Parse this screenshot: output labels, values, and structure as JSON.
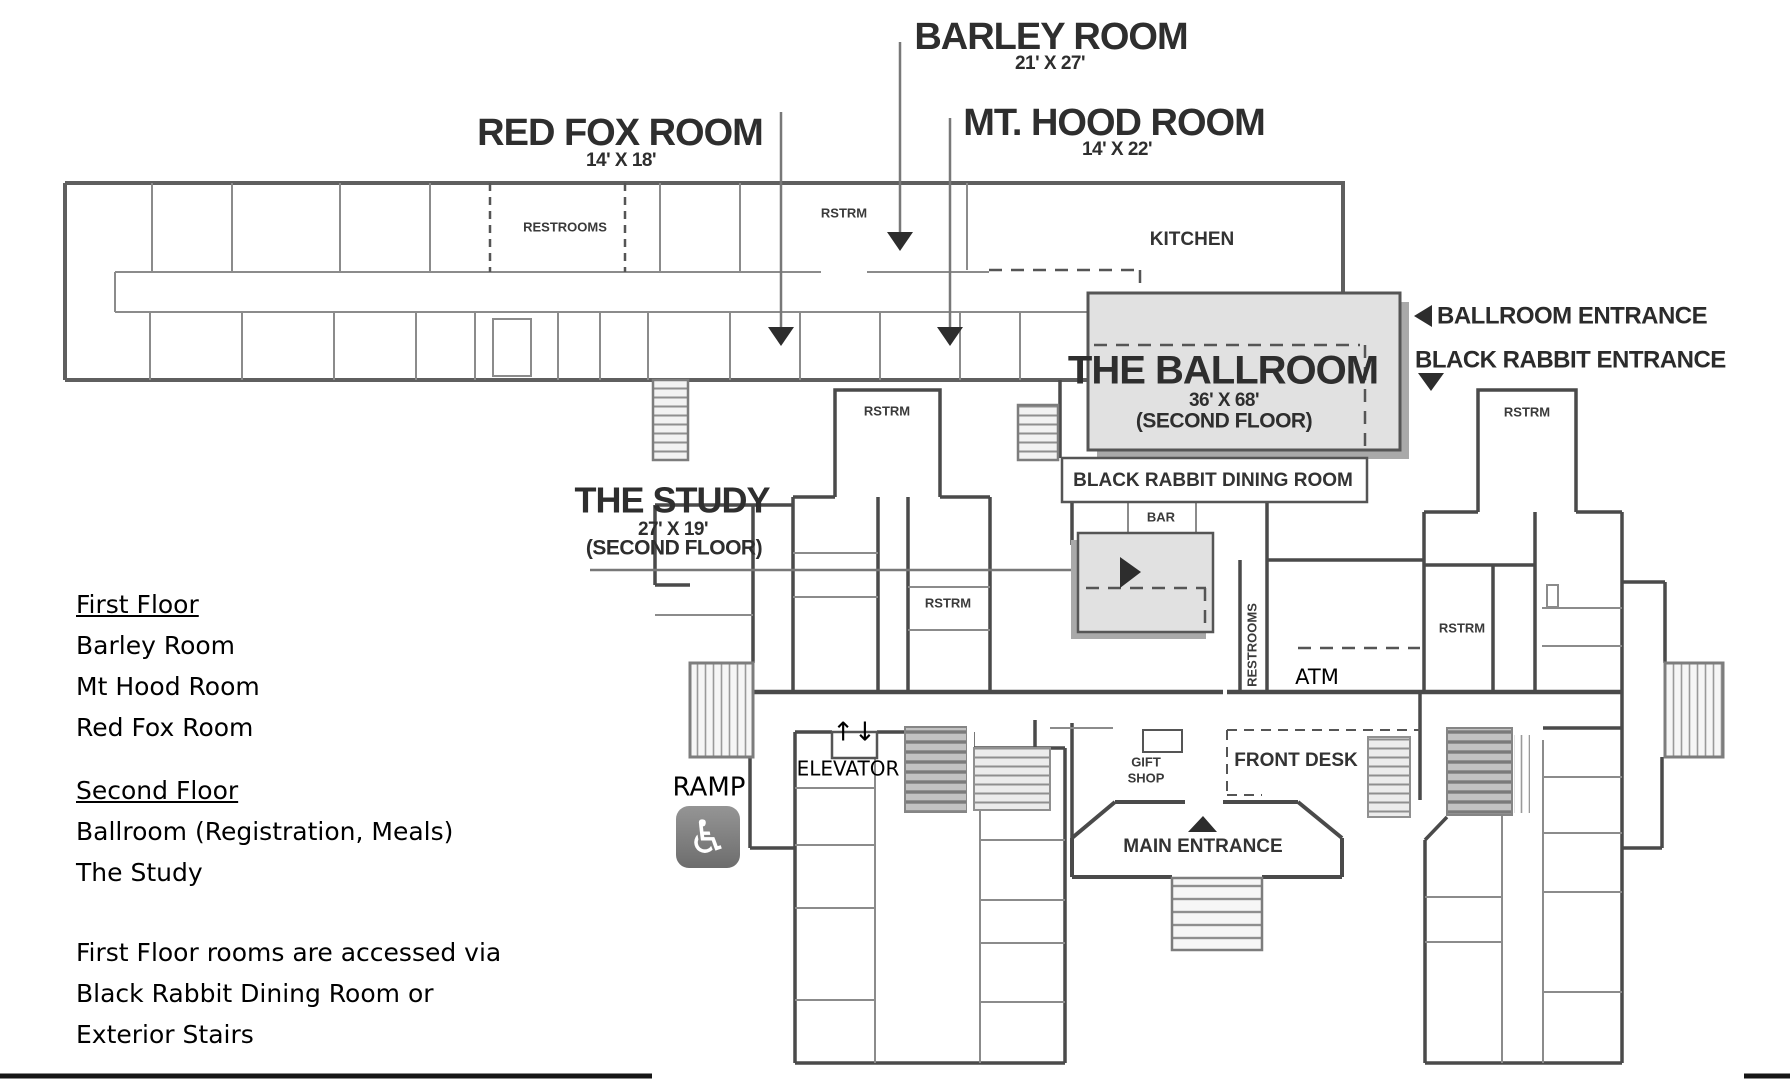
{
  "rooms": {
    "barley": {
      "name": "BARLEY ROOM",
      "dims": "21' X 27'"
    },
    "red_fox": {
      "name": "RED FOX ROOM",
      "dims": "14' X 18'"
    },
    "mt_hood": {
      "name": "MT. HOOD ROOM",
      "dims": "14' X 22'"
    },
    "ballroom": {
      "name": "THE BALLROOM",
      "dims": "36' X 68'",
      "floor_note": "(SECOND FLOOR)"
    },
    "study": {
      "name": "THE STUDY",
      "dims": "27' X 19'",
      "floor_note": "(SECOND FLOOR)"
    }
  },
  "plan_labels": {
    "restrooms": "RESTROOMS",
    "rstrm_top_wing": "RSTRM",
    "kitchen": "KITCHEN",
    "dining": "BLACK RABBIT DINING ROOM",
    "bar": "BAR",
    "rstrm_right_top": "RSTRM",
    "rstrm_mid_left": "RSTRM",
    "rstrm_mid": "RSTRM",
    "rstrm_mid_right": "RSTRM",
    "restrooms_vertical": "RESTROOMS",
    "gift_shop_line1": "GIFT",
    "gift_shop_line2": "SHOP",
    "front_desk": "FRONT DESK",
    "main_entrance": "MAIN ENTRANCE"
  },
  "entrance_labels": {
    "ballroom_entrance": "BALLROOM ENTRANCE",
    "black_rabbit_entrance": "BLACK RABBIT ENTRANCE"
  },
  "overlay_labels": {
    "ramp": "RAMP",
    "elevator": "ELEVATOR",
    "elevator_arrows": "↑↓",
    "atm": "ATM",
    "accessibility_symbol": "♿"
  },
  "legend": {
    "first_floor": {
      "heading": "First Floor",
      "rooms": [
        "Barley Room",
        "Mt Hood Room",
        "Red Fox Room"
      ]
    },
    "second_floor": {
      "heading": "Second Floor",
      "rooms": [
        "Ballroom (Registration, Meals)",
        "The Study"
      ]
    },
    "note": [
      "First Floor rooms are accessed via",
      "Black Rabbit Dining Room or",
      "Exterior Stairs"
    ]
  },
  "colors": {
    "wall": "#5f5f5f",
    "heavy_wall": "#4a4a4a",
    "partition": "#8b8b8b",
    "room_fill": "#e1e1e1",
    "shadow": "#a9a9a9",
    "label": "#2e2e2e",
    "border_line": "#161616",
    "icon_bg": "#7d7d7d",
    "background": "#ffffff"
  }
}
